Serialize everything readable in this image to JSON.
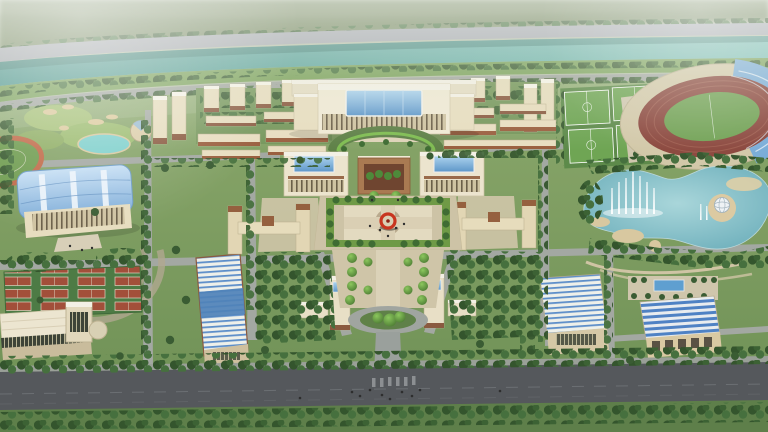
{
  "scene": {
    "type": "aerial-architectural-rendering",
    "subject": "university-campus-master-plan-birds-eye-view",
    "landmarks": [
      "misty-hills",
      "riverside-embankment-road",
      "river",
      "campus-ring-road",
      "golf-garden",
      "garden-pond",
      "running-track-field",
      "gymnasium",
      "tennis-courts",
      "natatorium",
      "workshop-building",
      "dormitory-cluster-west",
      "dormitory-cluster-east",
      "main-academic-building",
      "entrance-gate-complex",
      "central-plaza",
      "red-ring-sculpture",
      "tree-lined-promenade",
      "oval-traffic-island",
      "main-boulevard",
      "courtyard-buildings",
      "soccer-fields",
      "stadium",
      "grandstand-roof",
      "lake",
      "fountain-jets",
      "island-sphere-pavilion",
      "lab-buildings-southeast",
      "formal-garden-pool"
    ]
  },
  "palette": {
    "sky_haze": "#b6c0aa",
    "hills": "#74885f",
    "embankment": "#a3a7ae",
    "river": "#5ca49c",
    "bank": "#7ba25c",
    "ground": "#7a9b60",
    "road": "#a3a8a2",
    "boulevard": "#55585c",
    "path_tan": "#cdc3a6",
    "tree_dark": "#3a5c33",
    "tree_bright": "#6fae3f",
    "wall_cream": "#e7ddbf",
    "building_light": "#efe9d4",
    "roof_white": "#f3f0e5",
    "brown": "#8a5a40",
    "red_brown": "#9a5f3f",
    "glass": "#6fa6d4",
    "gym_roof": "#9cc6e6",
    "track": "#8a463c",
    "court": "#a24f3a",
    "pitch": "#6fa554",
    "lake": "#84c2cc",
    "sand": "#dccaa2",
    "sculpture": "#c8351f",
    "fountain": "#ffffff"
  }
}
